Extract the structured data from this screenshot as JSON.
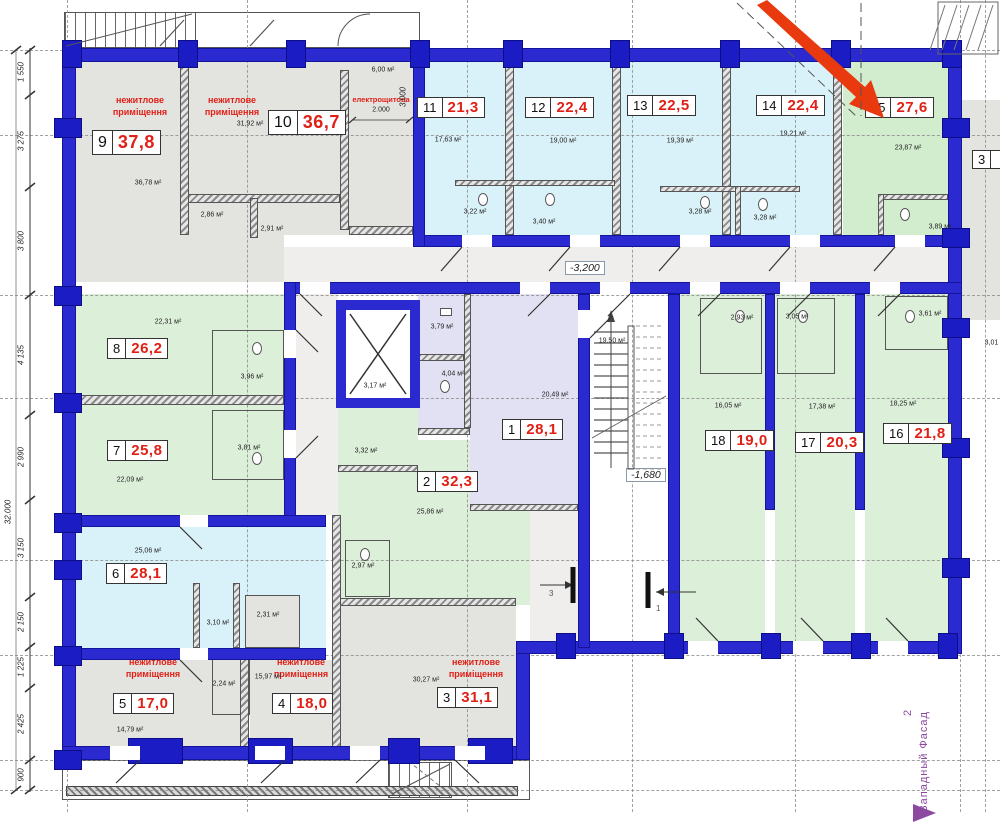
{
  "texts": {
    "nonres1": "нежитлове",
    "nonres2": "приміщення",
    "electrical": "електрощитова",
    "elevCorridor": "-3,200",
    "elevStair": "-1,680",
    "facade": "Западный Фасад",
    "facadeNum": "2",
    "dimTotal": "32.000",
    "dim2000": "2.000",
    "dim3000": "3.000",
    "marker3": "3",
    "marker1": "1"
  },
  "dims": [
    "1 550",
    "3 275",
    "3 800",
    "4 135",
    "2 990",
    "3 150",
    "2 150",
    "1 225",
    "2 425",
    "900"
  ],
  "units": {
    "u1": {
      "n": "1",
      "a": "28,1"
    },
    "u2": {
      "n": "2",
      "a": "32,3"
    },
    "u3": {
      "n": "3",
      "a": "31,1"
    },
    "u4": {
      "n": "4",
      "a": "18,0"
    },
    "u5": {
      "n": "5",
      "a": "17,0"
    },
    "u6": {
      "n": "6",
      "a": "28,1"
    },
    "u7": {
      "n": "7",
      "a": "25,8"
    },
    "u8": {
      "n": "8",
      "a": "26,2"
    },
    "u9": {
      "n": "9",
      "a": "37,8"
    },
    "u10": {
      "n": "10",
      "a": "36,7"
    },
    "u11": {
      "n": "11",
      "a": "21,3"
    },
    "u12": {
      "n": "12",
      "a": "22,4"
    },
    "u13": {
      "n": "13",
      "a": "22,5"
    },
    "u14": {
      "n": "14",
      "a": "22,4"
    },
    "u15": {
      "n": "15",
      "a": "27,6"
    },
    "u16": {
      "n": "16",
      "a": "21,8"
    },
    "u17": {
      "n": "17",
      "a": "20,3"
    },
    "u18": {
      "n": "18",
      "a": "19,0"
    },
    "uSide": {
      "n": "3",
      "a": ""
    }
  },
  "areas": {
    "r9": "36,78 м²",
    "r9a": "2,86 м²",
    "r9b": "2,91 м²",
    "r10": "31,92 м²",
    "rel": "6,00 м²",
    "r11": "17,63 м²",
    "r11b": "3,22 м²",
    "r12": "19,00 м²",
    "r12b": "3,40 м²",
    "r13": "19,39 м²",
    "r13b": "3,28 м²",
    "r14": "19,21 м²",
    "r14b": "3,28 м²",
    "r15": "23,87 м²",
    "r15b": "3,89 м²",
    "r8": "22,31 м²",
    "r8b": "3,96 м²",
    "r7": "22,09 м²",
    "r7b": "3,81 м²",
    "rh1": "3,79 м²",
    "rh2": "4,04 м²",
    "rh3": "3,17 м²",
    "rh4": "3,32 м²",
    "r2": "25,86 м²",
    "r2b": "2,97 м²",
    "r1": "20,49 м²",
    "rst": "19,50 м²",
    "r18": "16,05 м²",
    "r18b": "2,93 м²",
    "r17": "17,38 м²",
    "r17b": "3,05 м²",
    "r16": "18,25 м²",
    "r16b": "3,61 м²",
    "rside": "3,01 м²",
    "r6": "25,06 м²",
    "r6b": "3,10 м²",
    "r5": "14,79 м²",
    "r5b": "2,24 м²",
    "r4": "15,97 м²",
    "r4b": "2,31 м²",
    "r3": "30,27 м²"
  }
}
